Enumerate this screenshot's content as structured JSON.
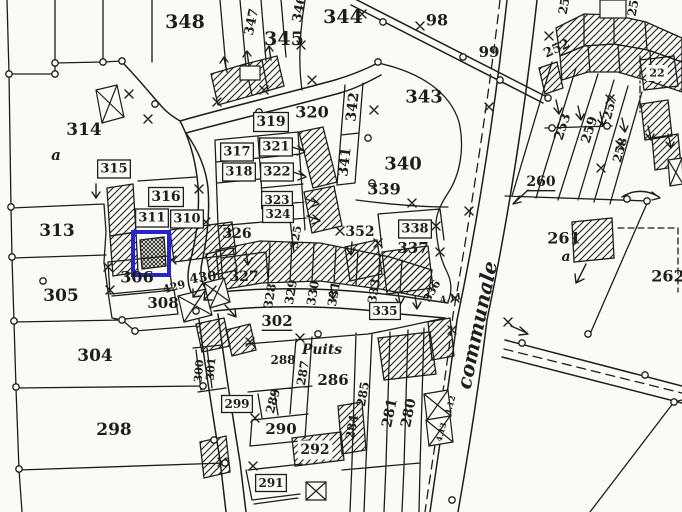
{
  "meta": {
    "title": "cadastral-map-extract",
    "background": "#fafaf6",
    "ink_color": "#1d1d1b",
    "highlight_color": "#2626c6"
  },
  "highlight": {
    "x": 133,
    "y": 232,
    "width": 36,
    "height": 43
  },
  "road_name": "communale",
  "well_label": "Puits",
  "labels": [
    {
      "t": "348",
      "x": 185,
      "y": 22,
      "s": 19
    },
    {
      "t": "347",
      "x": 252,
      "y": 22,
      "r": -78,
      "s": 13
    },
    {
      "t": "346",
      "x": 300,
      "y": 9,
      "r": -78,
      "s": 13
    },
    {
      "t": "345",
      "x": 284,
      "y": 39,
      "s": 19
    },
    {
      "t": "344",
      "x": 343,
      "y": 17,
      "s": 19
    },
    {
      "t": "98",
      "x": 437,
      "y": 20,
      "s": 16
    },
    {
      "t": "99",
      "x": 489,
      "y": 52,
      "s": 15
    },
    {
      "t": "343",
      "x": 424,
      "y": 97,
      "s": 18
    },
    {
      "t": "342",
      "x": 353,
      "y": 107,
      "r": -83,
      "s": 14
    },
    {
      "t": "341",
      "x": 345,
      "y": 162,
      "r": -83,
      "s": 14
    },
    {
      "t": "340",
      "x": 403,
      "y": 164,
      "s": 18
    },
    {
      "t": "339",
      "x": 384,
      "y": 189,
      "s": 16
    },
    {
      "t": "320",
      "x": 312,
      "y": 112,
      "s": 16
    },
    {
      "t": "319",
      "x": 271,
      "y": 122,
      "s": 14,
      "b": 1
    },
    {
      "t": "317",
      "x": 237,
      "y": 152,
      "s": 13,
      "b": 1
    },
    {
      "t": "318",
      "x": 239,
      "y": 172,
      "s": 13,
      "b": 1
    },
    {
      "t": "321",
      "x": 276,
      "y": 147,
      "s": 13,
      "b": 1
    },
    {
      "t": "322",
      "x": 277,
      "y": 172,
      "s": 13,
      "b": 1
    },
    {
      "t": "323",
      "x": 277,
      "y": 200,
      "s": 12,
      "b": 1
    },
    {
      "t": "324",
      "x": 278,
      "y": 214,
      "s": 12,
      "b": 1
    },
    {
      "t": "325",
      "x": 296,
      "y": 237,
      "r": -80,
      "s": 11
    },
    {
      "t": "326",
      "x": 237,
      "y": 234,
      "s": 14
    },
    {
      "t": "352",
      "x": 360,
      "y": 232,
      "s": 14
    },
    {
      "t": "338",
      "x": 415,
      "y": 229,
      "s": 13,
      "b": 1
    },
    {
      "t": "337",
      "x": 413,
      "y": 248,
      "s": 15
    },
    {
      "t": "336",
      "x": 432,
      "y": 291,
      "r": -60,
      "s": 11
    },
    {
      "t": "4.11",
      "x": 451,
      "y": 299,
      "r": -10,
      "s": 9
    },
    {
      "t": "314",
      "x": 84,
      "y": 130,
      "s": 17
    },
    {
      "t": "a",
      "x": 56,
      "y": 155,
      "s": 15,
      "i": 1
    },
    {
      "t": "315",
      "x": 114,
      "y": 169,
      "s": 13,
      "b": 1
    },
    {
      "t": "316",
      "x": 166,
      "y": 197,
      "s": 14,
      "b": 1
    },
    {
      "t": "311",
      "x": 152,
      "y": 218,
      "s": 13,
      "b": 1
    },
    {
      "t": "310",
      "x": 187,
      "y": 219,
      "s": 13,
      "b": 1
    },
    {
      "t": "313",
      "x": 57,
      "y": 231,
      "s": 17
    },
    {
      "t": "305",
      "x": 61,
      "y": 296,
      "s": 17
    },
    {
      "t": "306",
      "x": 137,
      "y": 277,
      "s": 16
    },
    {
      "t": "308",
      "x": 163,
      "y": 303,
      "s": 15
    },
    {
      "t": "429",
      "x": 174,
      "y": 287,
      "r": -15,
      "s": 11
    },
    {
      "t": "430",
      "x": 203,
      "y": 278,
      "r": -8,
      "s": 13
    },
    {
      "t": "327",
      "x": 244,
      "y": 277,
      "s": 14
    },
    {
      "t": "328",
      "x": 270,
      "y": 296,
      "r": -80,
      "s": 12
    },
    {
      "t": "329",
      "x": 291,
      "y": 292,
      "r": -80,
      "s": 12
    },
    {
      "t": "330",
      "x": 313,
      "y": 293,
      "r": -80,
      "s": 12
    },
    {
      "t": "331",
      "x": 334,
      "y": 294,
      "r": -80,
      "s": 12
    },
    {
      "t": "333",
      "x": 374,
      "y": 291,
      "r": -80,
      "s": 12
    },
    {
      "t": "335",
      "x": 385,
      "y": 311,
      "s": 12,
      "b": 1
    },
    {
      "t": "302",
      "x": 277,
      "y": 321,
      "s": 15,
      "u": 1
    },
    {
      "t": "304",
      "x": 95,
      "y": 356,
      "s": 17
    },
    {
      "t": "298",
      "x": 114,
      "y": 430,
      "s": 17
    },
    {
      "t": "300",
      "x": 199,
      "y": 371,
      "r": -85,
      "s": 11
    },
    {
      "t": "301",
      "x": 211,
      "y": 369,
      "r": -85,
      "s": 11
    },
    {
      "t": "299",
      "x": 237,
      "y": 404,
      "s": 12,
      "b": 1
    },
    {
      "t": "Puits",
      "x": 322,
      "y": 350,
      "s": 14,
      "i": 1
    },
    {
      "t": "288",
      "x": 283,
      "y": 360,
      "s": 12
    },
    {
      "t": "287",
      "x": 303,
      "y": 373,
      "r": -80,
      "s": 12
    },
    {
      "t": "286",
      "x": 333,
      "y": 380,
      "s": 15
    },
    {
      "t": "289",
      "x": 273,
      "y": 401,
      "r": -75,
      "s": 12
    },
    {
      "t": "290",
      "x": 281,
      "y": 429,
      "s": 15
    },
    {
      "t": "292",
      "x": 315,
      "y": 450,
      "s": 14,
      "c": 1
    },
    {
      "t": "291",
      "x": 271,
      "y": 483,
      "s": 12,
      "b": 1
    },
    {
      "t": "285",
      "x": 363,
      "y": 394,
      "r": -80,
      "s": 12
    },
    {
      "t": "284",
      "x": 352,
      "y": 427,
      "r": -80,
      "s": 12
    },
    {
      "t": "281",
      "x": 390,
      "y": 413,
      "r": -78,
      "s": 14
    },
    {
      "t": "280",
      "x": 409,
      "y": 413,
      "r": -78,
      "s": 14
    },
    {
      "t": "260",
      "x": 541,
      "y": 182,
      "s": 14,
      "u": 1
    },
    {
      "t": "261",
      "x": 564,
      "y": 238,
      "s": 16
    },
    {
      "t": "a",
      "x": 566,
      "y": 257,
      "s": 14,
      "i": 1
    },
    {
      "t": "262",
      "x": 668,
      "y": 276,
      "s": 16
    },
    {
      "t": "252",
      "x": 557,
      "y": 49,
      "r": -25,
      "s": 13
    },
    {
      "t": "253",
      "x": 563,
      "y": 127,
      "r": -72,
      "s": 13
    },
    {
      "t": "259",
      "x": 590,
      "y": 130,
      "r": -72,
      "s": 13
    },
    {
      "t": "257",
      "x": 610,
      "y": 107,
      "r": -75,
      "s": 12
    },
    {
      "t": "258",
      "x": 620,
      "y": 150,
      "r": -75,
      "s": 12
    },
    {
      "t": "25",
      "x": 564,
      "y": 6,
      "r": -80,
      "s": 12
    },
    {
      "t": "25",
      "x": 633,
      "y": 8,
      "r": -80,
      "s": 12
    },
    {
      "t": "22",
      "x": 657,
      "y": 73,
      "s": 11,
      "c": 1
    },
    {
      "t": "4.12",
      "x": 450,
      "y": 405,
      "r": -75,
      "s": 8
    },
    {
      "t": "4.13",
      "x": 441,
      "y": 432,
      "r": -75,
      "s": 8
    },
    {
      "t": "communale",
      "x": 477,
      "y": 325,
      "r": -78,
      "s": 20,
      "i": 1
    }
  ]
}
